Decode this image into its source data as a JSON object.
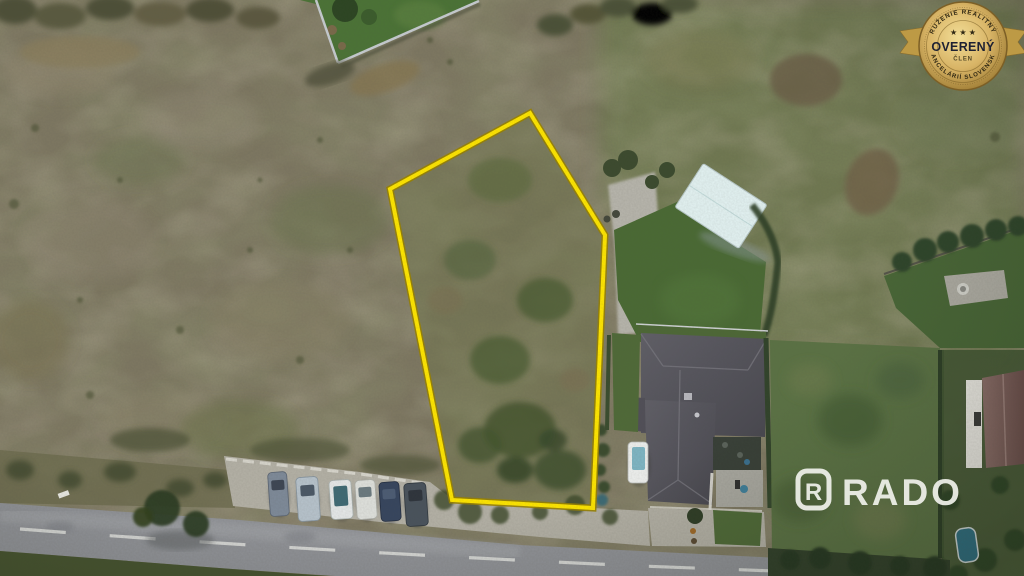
{
  "meta": {
    "type": "aerial-drone-photo",
    "subject": "building plot outlined in yellow beside residential houses and a road"
  },
  "badge": {
    "arc_top": "ZDRUŽENIE REALITNÝCH",
    "arc_bottom": "KANCELÁRIÍ SLOVENSKA",
    "stars": "★ ★ ★",
    "title": "OVERENÝ",
    "subtitle": "ČLEN",
    "colors": {
      "gold_light": "#f2dd96",
      "gold": "#cfa852",
      "gold_dark": "#9c7a32",
      "ribbon": "#bd9a45",
      "text_dark": "#1e2133",
      "text_arc": "#2f2713"
    }
  },
  "watermark": {
    "logo_letter": "R",
    "brand": "RADO",
    "color": "#f1f2ec"
  },
  "plot_outline": {
    "points": "530,113 605,235 593,508 452,500 390,189",
    "color": "#ffe600",
    "casing_color": "#9a8300"
  },
  "palette": {
    "field_base": "#7e7862",
    "field_green": "#6d7a4e",
    "plot_fill": "#6d7449",
    "garden_lawn": "#4b7336",
    "neighbor_lawn": "#4a6a34",
    "right_lawn": "#5b7244",
    "roof_main": "#55545c",
    "roof_far": "#7d615d",
    "road": "#919398",
    "gravel": "#b4b1a6",
    "white_structure": "#e3f2f2"
  },
  "vehicles": {
    "parked_car_colors": [
      "#7e8a99",
      "#b7c3cc",
      "#e6e9e9",
      "#dfe1dd",
      "#36455e",
      "#49525c"
    ],
    "van_color": "#eef0ee"
  }
}
